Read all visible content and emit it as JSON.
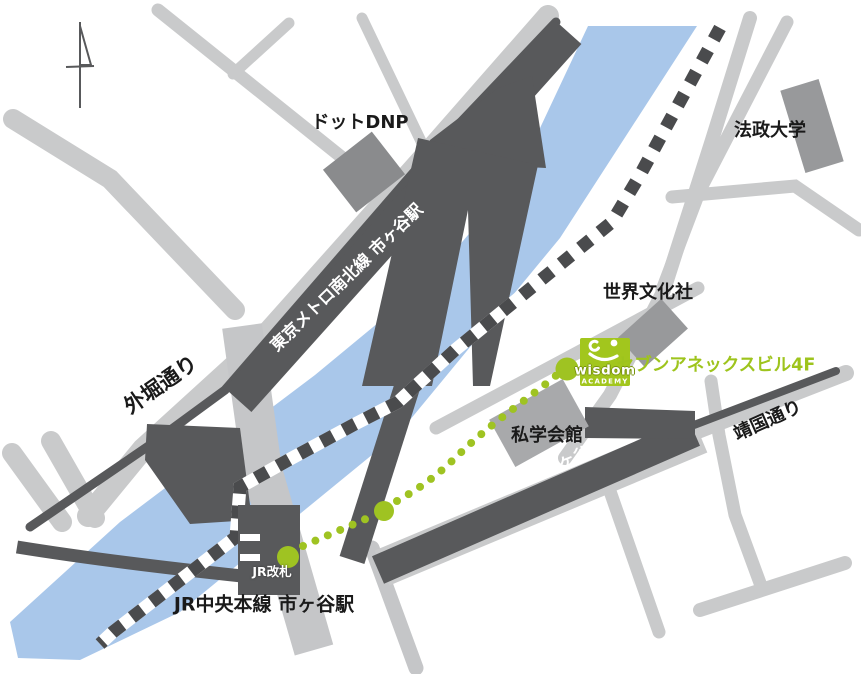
{
  "map": {
    "description_labels": {
      "dot_dnp": "ドットDNP",
      "hosei_university": "法政大学",
      "sekai_bunka_sha": "世界文化社",
      "shigaku_kaikan": "私学会館",
      "jr_chuo_line_station": "JR中央本線 市ヶ谷駅",
      "sotobori_dori": "外堀通り",
      "yasukuni_dori": "靖国通り",
      "metro_namboku_line_station": "東京メトロ南北線 市ヶ谷駅",
      "toei_shinjuku_line_station": "都営新宿線 市ヶ谷駅"
    },
    "route_markers": {
      "jr_gate": "JR改札",
      "exit_a1": "A1"
    },
    "destination": {
      "building": "セブンアネックスビル4F",
      "logo_name": "wisdom",
      "logo_sub": "ACADEMY"
    },
    "icons": {
      "north_arrow": "compass-north-arrow",
      "route_style": "green-dotted-walking-path",
      "rail_style": "black-white-dashed-jr-line"
    },
    "colors": {
      "river": "#a9c7ea",
      "road": "#c9cacb",
      "road-bridge": "#c5c6c8",
      "dark": "#58595b",
      "dash-dark": "#4a4b4d",
      "building-dark": "#8a8b8d",
      "building-mid": "#98999b",
      "building-light": "#a8a9ab",
      "green": "#9fc322",
      "logo-green": "#a2c61d",
      "logo-edge": "#7a9410",
      "text-green": "#9ec41d"
    }
  }
}
